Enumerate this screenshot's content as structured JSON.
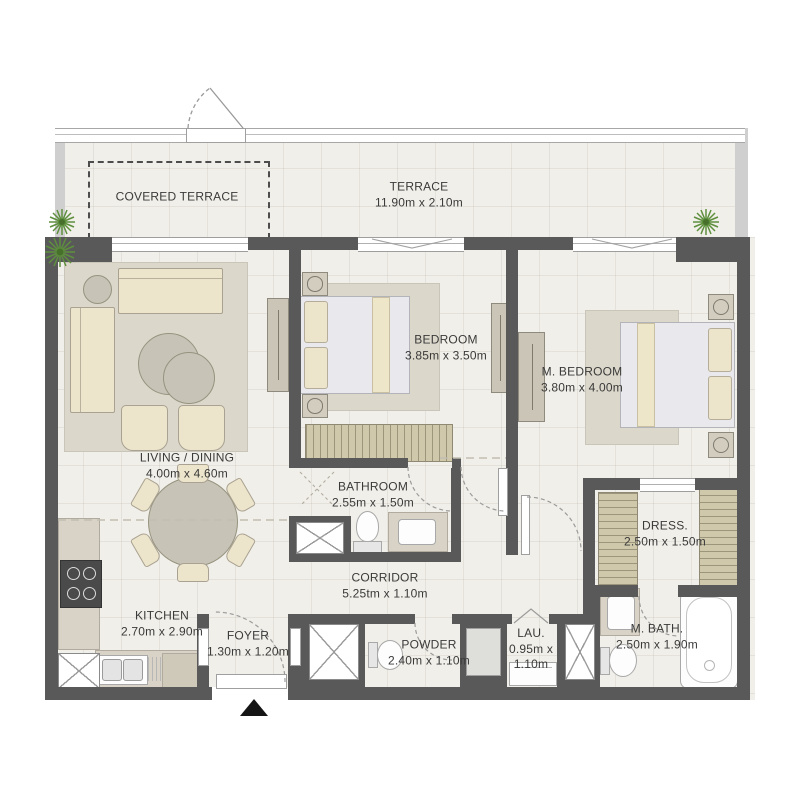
{
  "plan_type": "apartment-floor-plan",
  "rooms": {
    "covered_terrace": {
      "name": "COVERED TERRACE",
      "dims": ""
    },
    "terrace": {
      "name": "TERRACE",
      "dims": "11.90m x 2.10m"
    },
    "living_dining": {
      "name": "LIVING / DINING",
      "dims": "4.00m x 4.60m"
    },
    "bedroom": {
      "name": "BEDROOM",
      "dims": "3.85m x 3.50m"
    },
    "master_bedroom": {
      "name": "M. BEDROOM",
      "dims": "3.80m x 4.00m"
    },
    "bathroom": {
      "name": "BATHROOM",
      "dims": "2.55m x 1.50m"
    },
    "corridor": {
      "name": "CORRIDOR",
      "dims": "5.25tm x 1.10m"
    },
    "kitchen": {
      "name": "KITCHEN",
      "dims": "2.70m x 2.90m"
    },
    "foyer": {
      "name": "FOYER",
      "dims": "1.30m x 1.20m"
    },
    "powder": {
      "name": "POWDER",
      "dims": "2.40m x 1.10m"
    },
    "laundry": {
      "name": "LAU.",
      "dims": "0.95m x 1.10m"
    },
    "master_bath": {
      "name": "M. BATH.",
      "dims": "2.50m x 1.90m"
    },
    "dressing": {
      "name": "DRESS.",
      "dims": "2.50m x 1.50m"
    }
  },
  "colors": {
    "wall": "#595959",
    "floor": "#f1efe9",
    "furniture": "#ece5cb",
    "wardrobe": "#cfc8ab",
    "plant": "#5d8f3d",
    "text": "#3a3a3a"
  }
}
